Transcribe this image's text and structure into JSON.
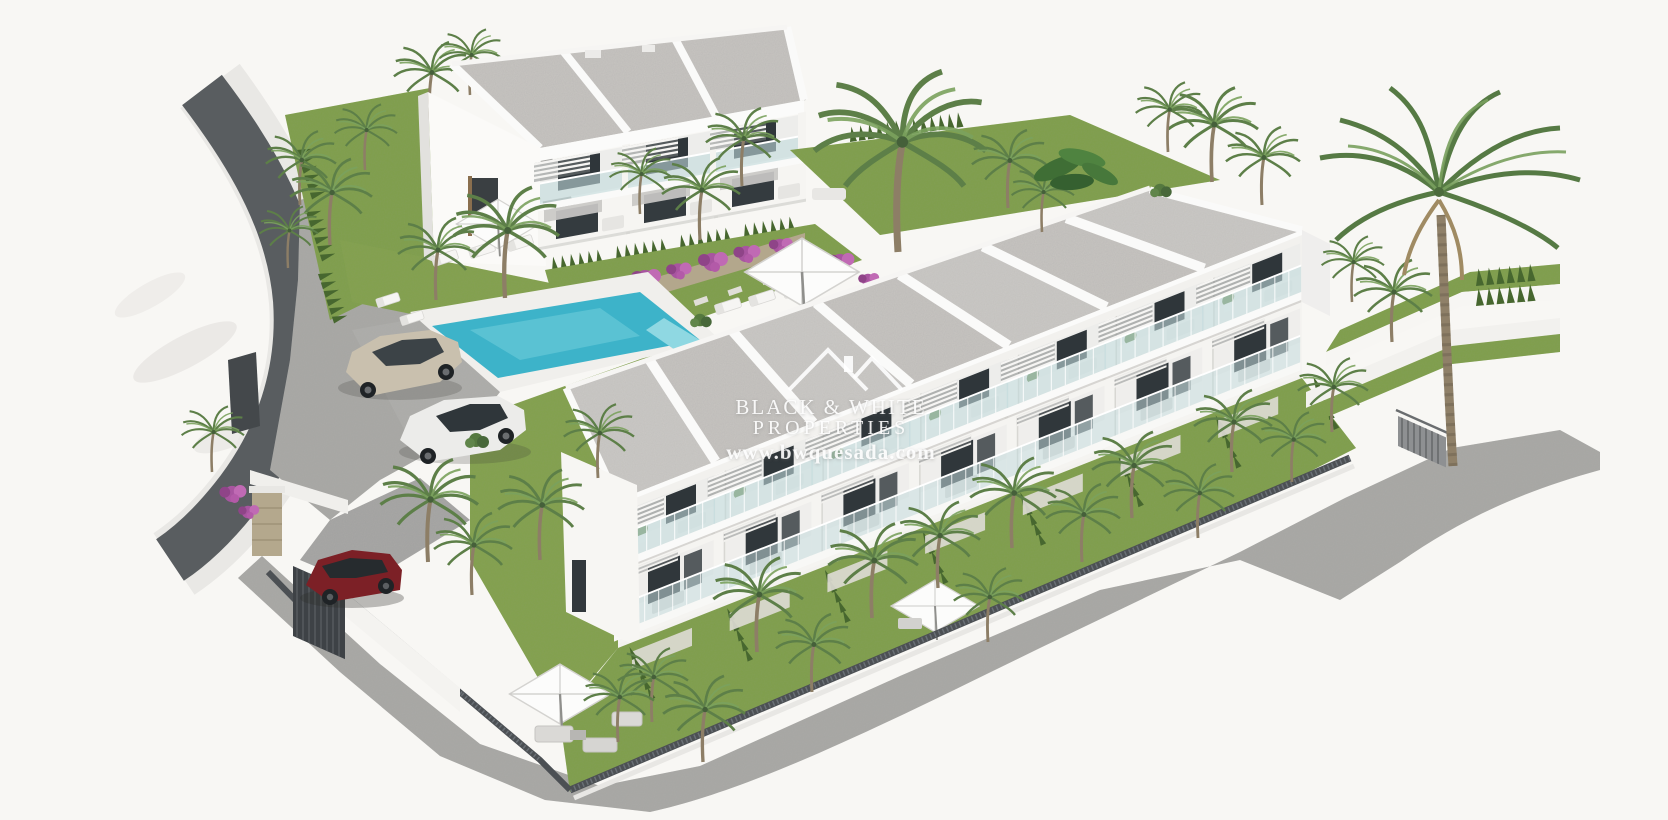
{
  "meta": {
    "title": "New-build residential development - aerial 3D render",
    "render_type": "exterior architectural visualization",
    "background": "#f8f7f4"
  },
  "watermark": {
    "logo": "twin-roof-outline",
    "line1": "BLACK & WHITE",
    "line2": "PROPERTIES",
    "line3": "www.bwquesada.com",
    "text_color": "#ffffff"
  },
  "palette": {
    "background": "#f8f7f4",
    "roof_gravel": "#c7c5c1",
    "wall_white": "#fbfbfa",
    "wall_shadow": "#e4e3e0",
    "pool_water": "#3db3c9",
    "pool_water_light": "#7fd4df",
    "lawn_green": "#7f9f4b",
    "hedge_green": "#47672f",
    "palm_green": "#5d7f48",
    "palm_trunk": "#8d7e66",
    "paving_grey": "#a6a6a3",
    "road_wall_dark": "#595d60",
    "fence_dark": "#4c5054",
    "stone_wall": "#b3a78c",
    "bougainvillea": "#a855a0",
    "glass_teal": "#c2dbdc",
    "car_red": "#7c2026",
    "car_beige": "#c9c0ae",
    "car_white": "#ececea"
  },
  "scene": {
    "buildings": [
      {
        "id": "block-a",
        "label": "two-storey block with roof terraces",
        "units_visible": 3
      },
      {
        "id": "row-b",
        "label": "townhouse row with terraces and private gardens",
        "units_visible": 7
      }
    ],
    "amenities": [
      "communal swimming pool",
      "sun loungers",
      "parasols",
      "landscaped gardens",
      "parking area",
      "carport"
    ],
    "vehicles": [
      {
        "type": "sedan",
        "color_name": "beige"
      },
      {
        "type": "coupe",
        "color_name": "white"
      },
      {
        "type": "suv",
        "color_name": "dark red"
      }
    ],
    "vegetation": [
      "palm trees",
      "cypress hedges",
      "bougainvillea",
      "lawns"
    ]
  }
}
